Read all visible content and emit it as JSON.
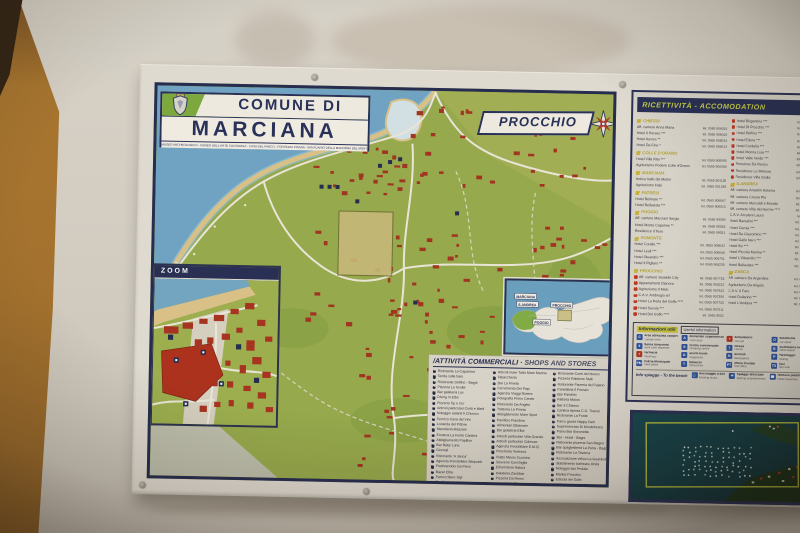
{
  "colors": {
    "navy": "#232d56",
    "map_green": "#96ac4d",
    "sea_blue": "#6da6c9",
    "building_red": "#a33121",
    "accent_yellow": "#c6d048",
    "wall_ochre": "#a8752f",
    "beach_tan": "#dcc58c"
  },
  "sign": {
    "title_block": {
      "line1": "COMUNE DI",
      "line2": "MARCIANA",
      "subtitle": "MUSEO ARCHEOLOGICO - MUSEO DELL'ARTE CONTADINA - CASA DEL PARCO - FORTEZZA PISANA - SANTUARIO DELLA MADONNA DEL MONTE"
    },
    "area_label": "PROCCHIO",
    "zoom_inset": {
      "label": "ZOOM"
    },
    "island_inset": {
      "labels": [
        "MARCIANA",
        "S.ANDREA",
        "POGGIO",
        "PROCCHIO"
      ]
    },
    "shops": {
      "title_it": "ATTIVITÀ COMMERCIALI",
      "title_en": "SHOPS AND STORES",
      "columns": [
        [
          "Ristorante La Caparrina",
          "Tenda sulla baia",
          "Ristorante Delfino - Bagni",
          "Pizzeria La Svolta",
          "Bar gelateria Lux",
          "Diving in Elba",
          "Pizzeria Tip e Go'",
          "Articoli particolari Conti e Medi",
          "Noleggio natanti Il Chiosco",
          "Tecnico Casa del Vino",
          "Locanda del Pittore",
          "Macelleria Mazzarri",
          "Enoteca La Fonte Cantina",
          "Abbigliamento Papillon",
          "Bar Baby Luna",
          "Giornali",
          "Ristorante 'A Janca'",
          "Agenzia immobiliare Bisquarti",
          "Fruttivendolo Da Piero",
          "Bazar Elba",
          "Parrucchiere Styl",
          "Bar Centrale"
        ],
        [
          "Articoli mare Tutto Mare Marina",
          "Tabaccheria",
          "Bar La Pineta",
          "Ferramenta Dei Papi",
          "Agenzia Viaggi Riviera",
          "Fotografia Primo Center",
          "Ristorante Da Angelo",
          "Trattoria La Pineta",
          "Abbigliamento Mare Sport",
          "Panificio Frandina",
          "Alimentari Elbamare",
          "Bar gelateria Elba",
          "Articoli particolari Villa Grande",
          "Articoli particolari Cidiesse",
          "Agenzia immobiliare E.M.Q.",
          "Pescheria Vanessa",
          "Piatto Mauro Cucinino",
          "Souvenir Conchiglia",
          "Erboristeria Natura",
          "Gelateria Zanzibar",
          "Pizzeria Da Remo",
          "Lavanderia Blu"
        ],
        [
          "Ristorante Conti del Nuovo",
          "Pizzeria Rainbow Stab",
          "Ristorante Pizzeria del Paiano",
          "Panetteria Il Fornaio",
          "Bar Pandino",
          "Fattoria Mauro",
          "Bar Il Chiasso",
          "Cantina Aperta C.G. Tramei",
          "Ristorante La Fonte",
          "Parco giochi Happy Park",
          "Supermercato Di Montefresca",
          "Piano Bar Simonetta",
          "Bar - Hotel - Bagni",
          "Ristorante pizzeria San Magno",
          "Bar spaghetteria La Perla - Bagni",
          "Ristorante La Taverna",
          "Associazione velica La Guardiola",
          "Stabilimento balneare Onda",
          "Noleggio bici Pedala",
          "Market Procchio",
          "Edicola del Golfo"
        ]
      ]
    },
    "accommodation": {
      "title": "RICETTIVITÀ - ACCOMODATION",
      "columns": [
        [
          {
            "name": "CHIESSI",
            "entries": [
              [
                "Aff. camere Anna Maria",
                "tel. 0565 906031"
              ],
              [
                "Hotel Il Perseo ***",
                "tel. 0565 906010"
              ],
              [
                "Hotel Aurora **",
                "tel. 0565 906024"
              ],
              [
                "Hotel Da Fine *",
                "tel. 0565 906013"
              ]
            ]
          },
          {
            "name": "COLLE D'ORANO",
            "entries": [
              [
                "Hotel Villa Rita ***",
                "tel. 0565 908095"
              ],
              [
                "Agriturismo Podere Colle d'Orano",
                "tel. 0565 908268"
              ]
            ]
          },
          {
            "name": "MARCIANA",
            "entries": [
              [
                "Antica Valle dei Mulini",
                "tel. 0565 901138"
              ],
              [
                "Agriturismo Fabi",
                "tel. 0565 901339"
              ]
            ]
          },
          {
            "name": "PATRESI",
            "entries": [
              [
                "Hotel Belmare **",
                "tel. 0565 908067"
              ],
              [
                "Hotel Bellavista ***",
                "tel. 0565 908015"
              ]
            ]
          },
          {
            "name": "POGGIO",
            "entries": [
              [
                "Aff. camere Marciani Sergio",
                "tel. 0565 99058"
              ],
              [
                "Hotel Monte Capanne **",
                "tel. 0565 99083"
              ],
              [
                "Residence Il Teso",
                "tel. 0565 99031"
              ]
            ]
          },
          {
            "name": "POMONTE",
            "entries": [
              [
                "Hotel Corallo ***",
                "tel. 0565 906042"
              ],
              [
                "Hotel Leali ***",
                "tel. 0565 906046"
              ],
              [
                "Hotel Oleandro ***",
                "tel. 0565 906751"
              ],
              [
                "Hotel Il Pigliaro **",
                "tel. 0565 906235"
              ]
            ]
          },
          {
            "name": "PROCCHIO",
            "marked": true,
            "entries": [
              [
                "Aff. camere Seaside City",
                "tel. 0565 907733"
              ],
              [
                "Appartamenti Dianora",
                "tel. 0565 908222"
              ],
              [
                "Agriturismo Il Melo",
                "tel. 0565 907442"
              ],
              [
                "C.A.V. Ambrogio srl",
                "tel. 0565 907356"
              ],
              [
                "Hotel La Perla del Golfo ****",
                "tel. 0565 907733"
              ],
              [
                "Hotel Savoia ***",
                "tel. 0565 907211"
              ],
              [
                "Hotel Del Golfo ****",
                "tel. 0565 9502"
              ]
            ]
          }
        ],
        [
          {
            "name": "",
            "marked": true,
            "entries": [
              [
                "Hotel Brigantino ***",
                "tel. 0565 907453"
              ],
              [
                "Hotel Di Procchio ***",
                "tel. 0565 907477"
              ],
              [
                "Hotel Delfino ***",
                "tel. 0565 907455"
              ],
              [
                "Hotel Edera ***",
                "tel. 0565 907525"
              ],
              [
                "Hotel Cordelia ***",
                "tel. 0565 907262"
              ],
              [
                "Hotel Monna Lisa ***",
                "tel. 0565 907519"
              ],
              [
                "Hotel Valle Verde ***",
                "tel. 0565 907545"
              ],
              [
                "Pensione Da Renzo",
                "tel. 0565 907504"
              ],
              [
                "Residence Le Mimose",
                "tel. 0565 907546"
              ],
              [
                "Residence Villa Giulia",
                "tel. 0565 907526"
              ]
            ]
          },
          {
            "name": "S.ANDREA",
            "entries": [
              [
                "Aff. camere Anselmi Antonia",
                "tel. 0565 908036"
              ],
              [
                "Aff. camere Cresta Pia",
                "tel. 0565 908084"
              ],
              [
                "Aff. camere Mercaldi e Monda",
                "tel. 0565 908013"
              ],
              [
                "Aff. camere Villa del Germe ****",
                "tel. 0565 908055"
              ],
              [
                "C.A.V. Arcaleni Laura",
                "tel. 0565 97008"
              ],
              [
                "Hotel Barsalini ***",
                "tel. 0565 908013"
              ],
              [
                "Hotel Cernia ***",
                "tel. 0565 908194"
              ],
              [
                "Hotel Da Giacomino ***",
                "tel. 0565 908010"
              ],
              [
                "Hotel Gallo Nero ***",
                "tel. 0565 908017"
              ],
              [
                "Hotel Ilio ***",
                "tel. 0565 908018"
              ],
              [
                "Hotel Piccola Marina **",
                "tel. 0565 908050"
              ],
              [
                "Hotel L'Oleandro ***",
                "tel. 0565 908030"
              ],
              [
                "Hotel Bellavista ***",
                "tel. 0565 908015"
              ]
            ]
          },
          {
            "name": "ZANCA",
            "entries": [
              [
                "Aff. camere Da Argentina",
                "tel. 0565 908063"
              ],
              [
                "Agriturismo Da Angelo",
                "tel. 0565 908381"
              ],
              [
                "C.A.V. Il Faro",
                "tel. 0565 908281"
              ],
              [
                "Hotel Dollarino ***",
                "tel. 0565 908021"
              ],
              [
                "Hotel L'Andana ***",
                "tel. 0565 908031"
              ]
            ]
          }
        ]
      ]
    },
    "info": {
      "title_it": "Informazioni utili",
      "title_en": "Useful information",
      "beach_it": "Info spiagge",
      "beach_en": "To the beach",
      "items": [
        {
          "icon": "camper-area-icon",
          "glyph": "C",
          "it": "Area attrezzata camper",
          "en": "Camper area",
          "color": "blue"
        },
        {
          "icon": "food-shop-icon",
          "glyph": "A",
          "it": "Alimentari supermercato",
          "en": "Food shop",
          "color": "blue"
        },
        {
          "icon": "surgery-icon",
          "glyph": "+",
          "it": "Ambulatorio",
          "en": "First aid",
          "color": "red"
        },
        {
          "icon": "car-repair-icon",
          "glyph": "O",
          "it": "Autofficina",
          "en": "Car repair",
          "color": "blue"
        },
        {
          "icon": "bank-icon",
          "glyph": "€",
          "it": "Banca bancomat",
          "en": "Bank cash dispenser",
          "color": "blue"
        },
        {
          "icon": "shopping-centre-icon",
          "glyph": "S",
          "it": "Centro commerciale",
          "en": "Shopping centre",
          "color": "blue"
        },
        {
          "icon": "church-icon",
          "glyph": "†",
          "it": "Chiesa",
          "en": "Church",
          "color": "blue"
        },
        {
          "icon": "petrol-station-icon",
          "glyph": "B",
          "it": "Distributore benzina",
          "en": "Petrol station",
          "color": "blue"
        },
        {
          "icon": "pharmacy-icon",
          "glyph": "+",
          "it": "Farmacia",
          "en": "Pharmacy",
          "color": "red"
        },
        {
          "icon": "playground-icon",
          "glyph": "G",
          "it": "Giochi bimbi",
          "en": "Playground",
          "color": "blue"
        },
        {
          "icon": "newsagent-icon",
          "glyph": "N",
          "it": "Giornali",
          "en": "Newspapers",
          "color": "blue"
        },
        {
          "icon": "parking-icon",
          "glyph": "P",
          "it": "Parcheggio",
          "en": "Parking",
          "color": "blue"
        },
        {
          "icon": "town-police-icon",
          "glyph": "PM",
          "it": "Polizia Municipale",
          "en": "Town police",
          "color": "blue"
        },
        {
          "icon": "tobacconist-icon",
          "glyph": "T",
          "it": "Tabacchi",
          "en": "Tobacconist",
          "color": "blue"
        },
        {
          "icon": "post-office-icon",
          "glyph": "PT",
          "it": "Ufficio Postale",
          "en": "Post office",
          "color": "blue"
        },
        {
          "icon": "taxi-icon",
          "glyph": "TX",
          "it": "Taxi",
          "en": "Taxi rank",
          "color": "blue"
        }
      ],
      "extras": [
        {
          "icon": "mooring-buoys-icon",
          "glyph": "⚓",
          "it": "Ancoraggio a boe",
          "en": "Mooring buoys"
        },
        {
          "icon": "bathing-establishment-icon",
          "glyph": "☂",
          "it": "Spiagge attrezzate",
          "en": "Bathing establishments"
        },
        {
          "icon": "public-phone-icon",
          "glyph": "☎",
          "it": "Telefono pubblico",
          "en": "Public telephone"
        }
      ]
    }
  }
}
